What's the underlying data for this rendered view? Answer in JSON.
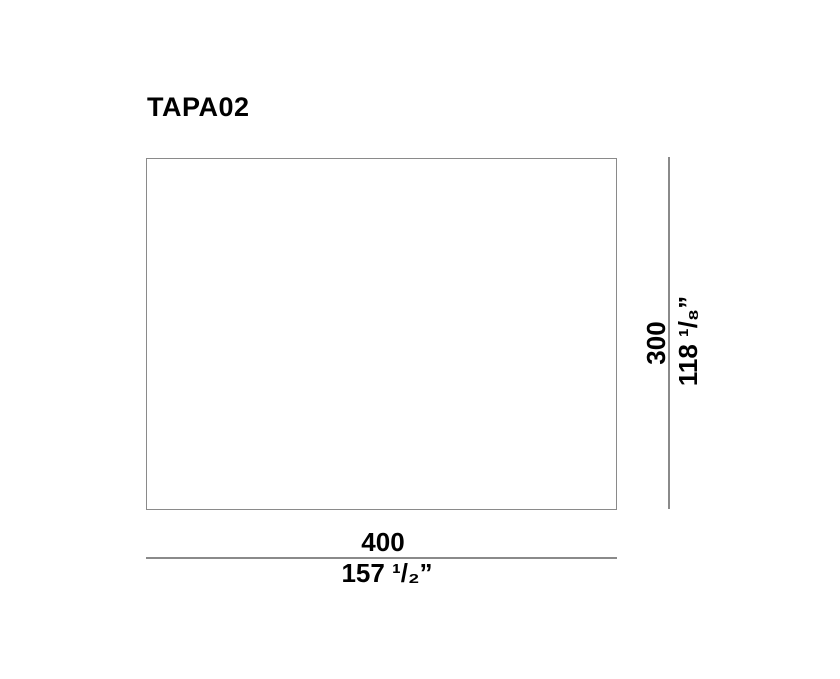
{
  "title": "TAPA02",
  "diagram": {
    "shape": "rectangle",
    "width_dimension": {
      "metric": "400",
      "imperial": "157 ¹/₂”"
    },
    "height_dimension": {
      "metric": "300",
      "imperial": "118 ¹/₈”"
    }
  },
  "colors": {
    "line": "#8a8a8a",
    "text": "#000000",
    "background": "#ffffff"
  }
}
